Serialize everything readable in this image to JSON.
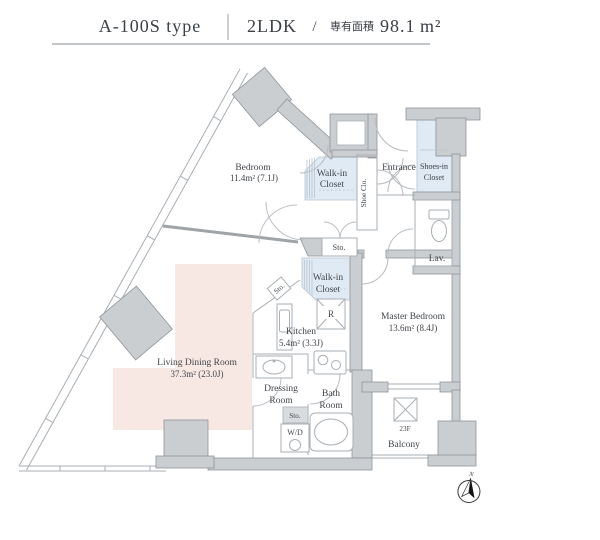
{
  "header": {
    "type_name": "A-100S type",
    "layout_type": "2LDK",
    "separator": "/",
    "area_label": "専有面積",
    "area_value": "98.1",
    "area_unit": "m²"
  },
  "plan": {
    "bedroom": {
      "name": "Bedroom",
      "area": "11.4m² (7.1J)"
    },
    "walk_in_closet_upper": {
      "line1": "Walk-in",
      "line2": "Closet"
    },
    "shoe_closet": {
      "name": "Shoe Clo."
    },
    "entrance": {
      "name": "Entrance"
    },
    "shoes_in_closet": {
      "line1": "Shoes-in",
      "line2": "Closet"
    },
    "lavatory": {
      "name": "Lav."
    },
    "storage_hall": {
      "name": "Sto."
    },
    "walk_in_closet_lower": {
      "line1": "Walk-in",
      "line2": "Closet"
    },
    "storage_kitchen": {
      "name": "Sto."
    },
    "refrigerator": {
      "name": "R"
    },
    "kitchen": {
      "name": "Kitchen",
      "area": "5.4m² (3.3J)"
    },
    "master_bedroom": {
      "name": "Master Bedroom",
      "area": "13.6m² (8.4J)"
    },
    "living_dining": {
      "name": "Living Dining Room",
      "area": "37.3m² (23.0J)"
    },
    "dressing_room": {
      "line1": "Dressing",
      "line2": "Room"
    },
    "storage_dressing": {
      "name": "Sto."
    },
    "washer_dryer": {
      "name": "W/D"
    },
    "bath_room": {
      "line1": "Bath",
      "line2": "Room"
    },
    "balcony": {
      "floor": "23F",
      "name": "Balcony"
    },
    "compass": {
      "north_label": "N"
    }
  },
  "palette": {
    "wall_fill": "#cbced1",
    "wall_stroke": "#8f9499",
    "thin_line": "#a9afb4",
    "door_arc": "#b7bcc1",
    "closet_fill": "#e0eaf4",
    "living_fill": "#f8e8e4",
    "text_color": "#41464c",
    "needle_color": "#111111"
  }
}
